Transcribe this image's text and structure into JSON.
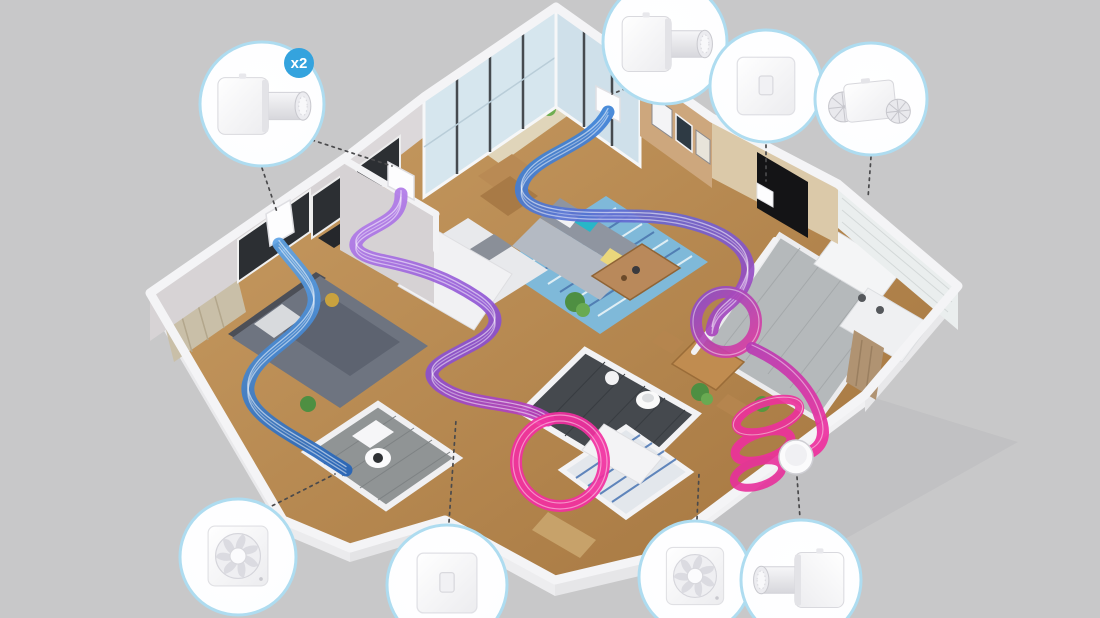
{
  "scene": {
    "subject": "isometric-apartment-ventilation-cutaway",
    "background_color": "#c8c8c9"
  },
  "badge": {
    "label": "x2"
  },
  "products": {
    "wall_ventilator": "wall-mounted single-room heat-recovery ventilator",
    "control_switch": "flat wall control switch panel",
    "inline_fan": "inline duct ventilation unit with twin grilles",
    "square_fan": "square exhaust fan",
    "round_vent": "round exterior wall vent cap"
  },
  "callouts": [
    {
      "id": "ventilator-bedrooms",
      "product_key": "wall_ventilator",
      "badge": "x2",
      "position": "top-left"
    },
    {
      "id": "ventilator-living",
      "product_key": "wall_ventilator",
      "badge": "",
      "position": "top-center"
    },
    {
      "id": "switch-entry",
      "product_key": "control_switch",
      "badge": "",
      "position": "top-right"
    },
    {
      "id": "inline-fan-kitchen",
      "product_key": "inline_fan",
      "badge": "",
      "position": "top-far-right"
    },
    {
      "id": "exhaust-fan-left-bath",
      "product_key": "square_fan",
      "badge": "",
      "position": "bottom-left"
    },
    {
      "id": "switch-hallway",
      "product_key": "control_switch",
      "badge": "",
      "position": "bottom-center"
    },
    {
      "id": "exhaust-fan-main-bath",
      "product_key": "square_fan",
      "badge": "",
      "position": "bottom-right"
    },
    {
      "id": "ventilator-exterior",
      "product_key": "wall_ventilator",
      "badge": "",
      "position": "bottom-far-right"
    },
    {
      "id": "round-vent-exterior",
      "product_key": "round_vent",
      "badge": "",
      "position": "right-wall"
    }
  ],
  "airflow_colors": {
    "supply_blue": "#2f6fc0",
    "transfer_purple": "#8a4fc9",
    "extract_magenta": "#ee309d"
  },
  "callout_style": {
    "ring_color": "#aedcf0",
    "badge_color": "#34a3de"
  }
}
